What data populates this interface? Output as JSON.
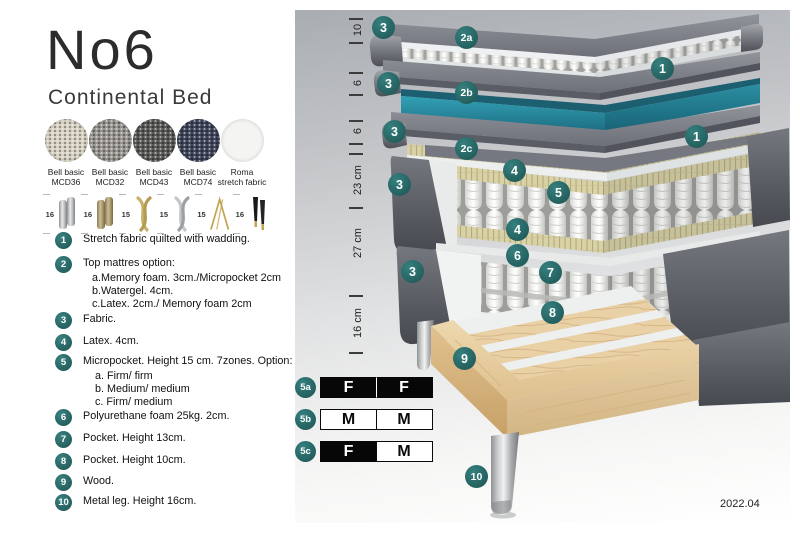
{
  "header": {
    "title": "No6",
    "subtitle": "Continental Bed"
  },
  "swatches": [
    {
      "label_line1": "Bell basic",
      "label_line2": "MCD36",
      "color": "#d6d1c2"
    },
    {
      "label_line1": "Bell basic",
      "label_line2": "MCD32",
      "color": "#97948f"
    },
    {
      "label_line1": "Bell basic",
      "label_line2": "MCD43",
      "color": "#585856"
    },
    {
      "label_line1": "Bell basic",
      "label_line2": "MCD74",
      "color": "#3e4459"
    },
    {
      "label_line1": "Roma",
      "label_line2": "stretch fabric",
      "color": "#f4f4f2"
    }
  ],
  "legs": [
    {
      "size": "16",
      "type": "cylinder-silver"
    },
    {
      "size": "16",
      "type": "cylinder-brass"
    },
    {
      "size": "15",
      "type": "twist-gold"
    },
    {
      "size": "15",
      "type": "twist-silver"
    },
    {
      "size": "15",
      "type": "hairpin-gold"
    },
    {
      "size": "16",
      "type": "cone-black-gold"
    }
  ],
  "legend": [
    {
      "num": "1",
      "text": "Stretch fabric quilted with wadding.",
      "subs": []
    },
    {
      "num": "2",
      "text": "Top mattres option:",
      "subs": [
        "a.Memory foam. 3cm./Micropocket 2cm",
        "b.Watergel. 4cm.",
        "c.Latex. 2cm./ Memory foam 2cm"
      ]
    },
    {
      "num": "3",
      "text": "Fabric.",
      "subs": []
    },
    {
      "num": "4",
      "text": "Latex. 4cm.",
      "subs": []
    },
    {
      "num": "5",
      "text": "Micropocket. Height 15 cm. 7zones. Option:",
      "subs": [
        "a. Firm/ firm",
        "b. Medium/ medium",
        "c. Firm/ medium"
      ]
    },
    {
      "num": "6",
      "text": "Polyurethane foam 25kg. 2cm.",
      "subs": []
    },
    {
      "num": "7",
      "text": "Pocket. Height 13cm.",
      "subs": []
    },
    {
      "num": "8",
      "text": "Pocket. Height 10cm.",
      "subs": []
    },
    {
      "num": "9",
      "text": "Wood.",
      "subs": []
    },
    {
      "num": "10",
      "text": "Metal leg. Height 16cm.",
      "subs": []
    }
  ],
  "diagram": {
    "dimensions": [
      "10",
      "6",
      "6",
      "23 cm",
      "27 cm",
      "16 cm"
    ],
    "badges": {
      "b1": "1",
      "b2a": "2a",
      "b2b": "2b",
      "b2c": "2c",
      "b3": "3",
      "b4": "4",
      "b5": "5",
      "b6": "6",
      "b7": "7",
      "b8": "8",
      "b9": "9",
      "b10": "10"
    },
    "colors": {
      "badge_teal": "#2a6c6b",
      "watergel_layer_teal": "#2b8ba0",
      "latex_band_khaki": "#d9d2a6",
      "wood_tan": "#e9d0a5",
      "fabric_gray": "#6e717a"
    },
    "version": "2022.04"
  },
  "firmness": [
    {
      "id": "5a",
      "cells": [
        {
          "letter": "F",
          "style": "dark"
        },
        {
          "letter": "F",
          "style": "dark"
        }
      ]
    },
    {
      "id": "5b",
      "cells": [
        {
          "letter": "M",
          "style": "light"
        },
        {
          "letter": "M",
          "style": "light"
        }
      ]
    },
    {
      "id": "5c",
      "cells": [
        {
          "letter": "F",
          "style": "dark"
        },
        {
          "letter": "M",
          "style": "light"
        }
      ]
    }
  ]
}
